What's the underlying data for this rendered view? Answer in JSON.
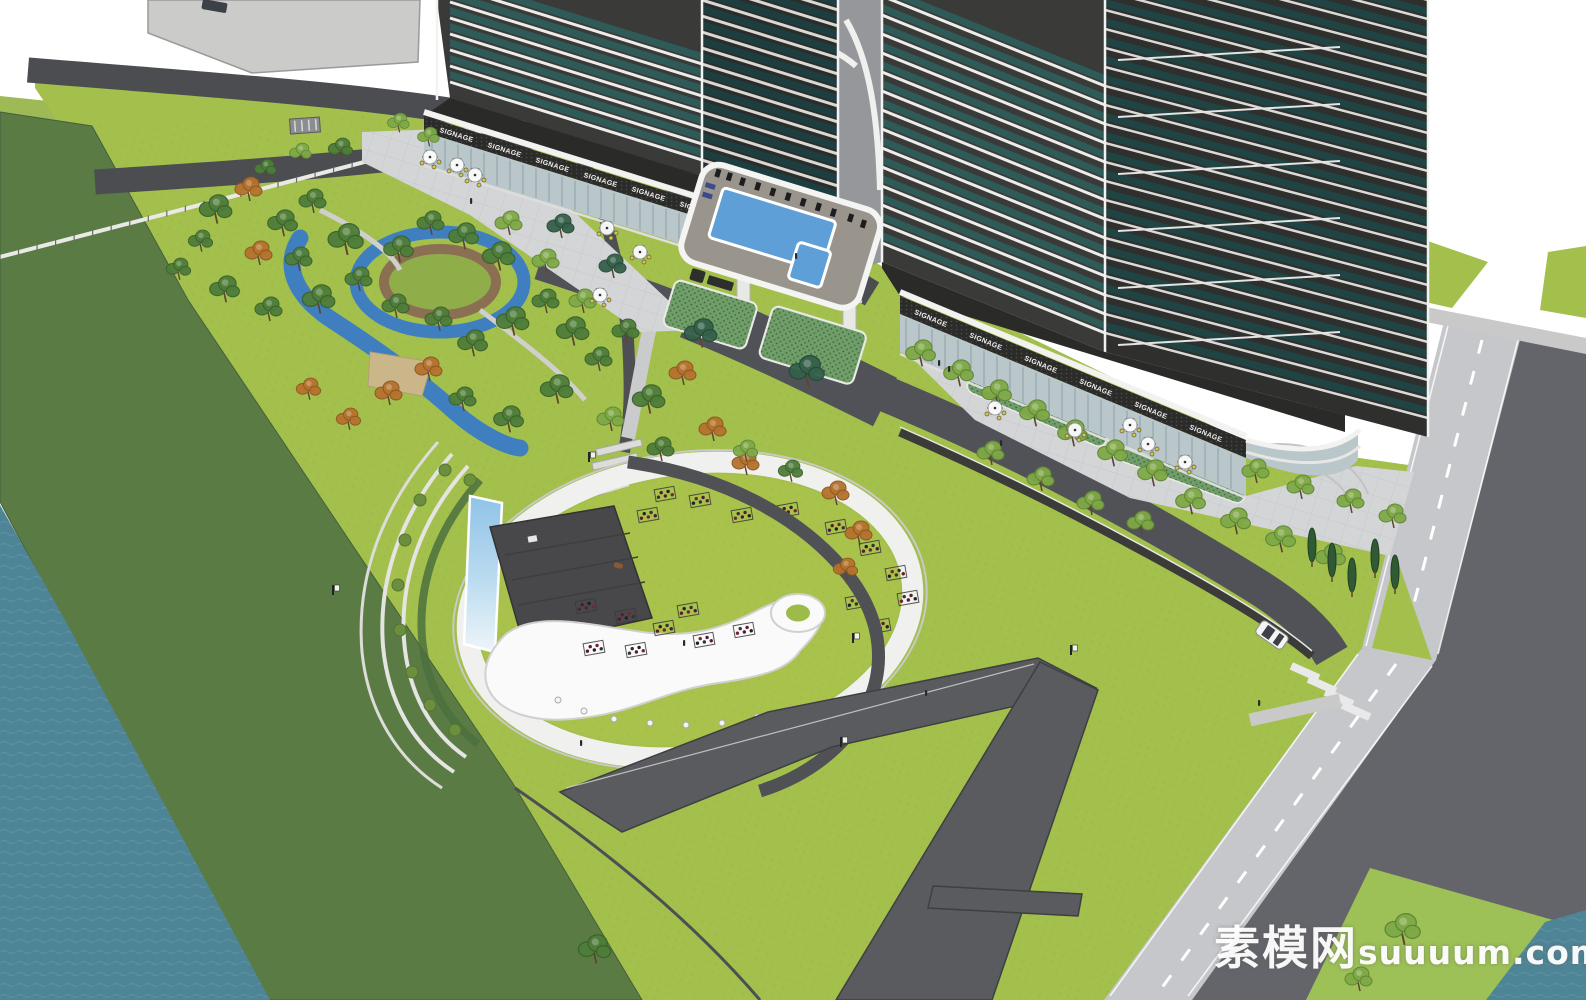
{
  "watermark": {
    "site_name_cn": "素模网",
    "site_domain": "suuuum.com"
  },
  "labels": {
    "storefront_signage": "SIGNAGE"
  },
  "palette": {
    "lawn_bright": "#a3bf4c",
    "lawn_event": "#a8c24b",
    "riverbank_green": "#5a7b44",
    "water_teal": "#4e8596",
    "road_dark": "#4e4f53",
    "drive_dark": "#515257",
    "road_light": "#c6c7ca",
    "pavement_dark": "#64656a",
    "plaza_paving": "#d4d5d6",
    "path_dark": "#5a5b5f",
    "building_dark": "#3a3a38",
    "building_shaded": "#2f2f2d",
    "glass_teal": "#2e5a58",
    "floor_band_white": "#ececea",
    "storefront_glass": "#b9c6ca",
    "signage_band": "#2b2b29",
    "pool_blue": "#5f9fd8",
    "playground_blue": "#3f7fc0",
    "terrace_deck": "#9a958c",
    "hedge_green": "#6f9e69",
    "canopy_white": "#fafafa",
    "stage_gray": "#48484b",
    "screen_sky_blue": "#8fc3e8",
    "sand_tan": "#cbb68a",
    "tree_green": "#4e7d3a",
    "tree_light": "#7fa947",
    "tree_autumn": "#b5722e",
    "tree_dark": "#35604a",
    "umbrella_white": "#fdfdfd",
    "chair_yellow": "#d8c93e"
  },
  "scene": {
    "type": "aerial-architectural-render",
    "subject": "residential-towers-with-landscape-park"
  }
}
